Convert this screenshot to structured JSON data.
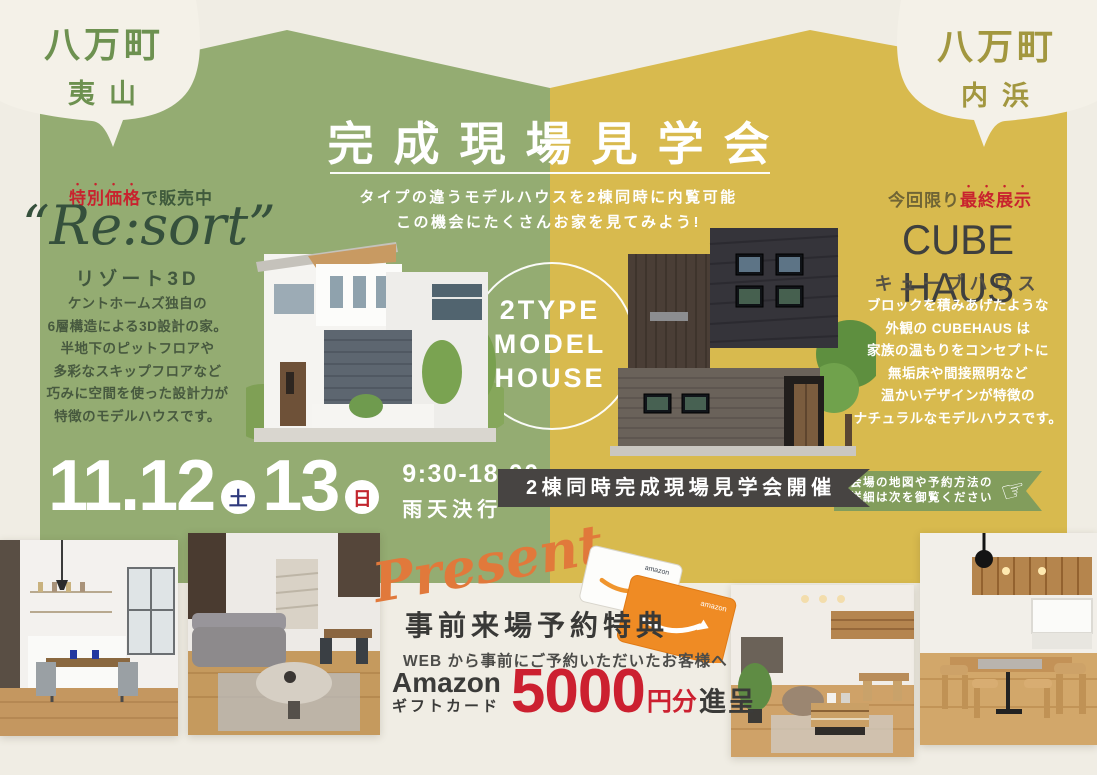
{
  "bubbles": {
    "left": {
      "line1": "八万町",
      "line2": "夷山"
    },
    "right": {
      "line1": "八万町",
      "line2": "内浜"
    }
  },
  "header": {
    "title": "完成現場見学会",
    "subtitle1": "タイプの違うモデルハウスを2棟同時に内覧可能",
    "subtitle2": "この機会にたくさんお家を見てみよう!"
  },
  "resort": {
    "badge_emphasis": "特別価格",
    "badge_rest": "で販売中",
    "name": "“Re:sort”",
    "kana": "リゾート3D",
    "description": [
      "ケントホームズ独自の",
      "6層構造による3D設計の家。",
      "半地下のピットフロアや",
      "多彩なスキップフロアなど",
      "巧みに空間を使った設計力が",
      "特徴のモデルハウスです。"
    ]
  },
  "cube": {
    "badge_prefix": "今回限り",
    "badge_emphasis": "最終展示",
    "name": "CUBE HAUS",
    "kana": "キューブハウス",
    "description": [
      "ブロックを積みあげたような",
      "外観の CUBEHAUS は",
      "家族の温もりをコンセプトに",
      "無垢床や間接照明など",
      "温かいデザインが特徴の",
      "ナチュラルなモデルハウスです。"
    ]
  },
  "center_circle": {
    "lines": [
      "2TYPE",
      "MODEL",
      "HOUSE"
    ]
  },
  "event": {
    "date1": "11.12",
    "day1": "土",
    "date2": "13",
    "day2": "日",
    "time": "9:30-18:00",
    "rain": "雨天決行",
    "banner": "2棟同時完成現場見学会開催",
    "ribbon_line1": "会場の地図や予約方法の",
    "ribbon_line2": "詳細は次を御覧ください",
    "hand_icon": "☞"
  },
  "present": {
    "script": "Present",
    "title": "事前来場予約特典",
    "lead": "WEB から事前にご予約いただいたお客様へ",
    "brand": "Amazon",
    "brand_sub": "ギフトカード",
    "amount": "5000",
    "amount_unit": "円分",
    "suffix": "進呈",
    "card_label": "amazon"
  },
  "colors": {
    "cream": "#f0ede4",
    "green_panel": "#94ac72",
    "yellow_panel": "#d8ba4e",
    "accent_red": "#c8232e",
    "banner_charcoal": "#474442",
    "ribbon_green": "#829d5c",
    "present_orange": "#e1793b"
  }
}
